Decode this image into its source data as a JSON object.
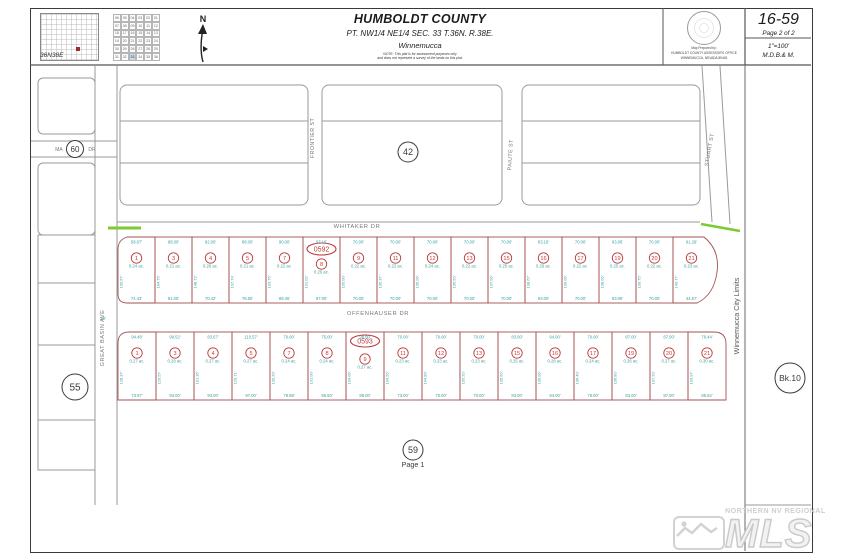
{
  "header": {
    "township_label": "36N38E",
    "north_label": "N",
    "section_grid": {
      "rows": [
        [
          "06",
          "05",
          "04",
          "03",
          "02",
          "01"
        ],
        [
          "07",
          "08",
          "09",
          "10",
          "11",
          "12"
        ],
        [
          "18",
          "17",
          "16",
          "15",
          "14",
          "13"
        ],
        [
          "19",
          "20",
          "21",
          "22",
          "23",
          "24"
        ],
        [
          "30",
          "29",
          "28",
          "27",
          "26",
          "25"
        ],
        [
          "31",
          "32",
          "33",
          "34",
          "35",
          "36"
        ]
      ],
      "highlight": "33"
    },
    "title": "HUMBOLDT COUNTY",
    "subtitle": "PT. NW1/4 NE1/4 SEC. 33 T.36N. R.38E.",
    "city": "Winnemucca",
    "note1": "NOTE: This plat is for assessment purposes only",
    "note2": "and does not represent a survey of the lands on this plat.",
    "seal_line1": "Map Prepared by:",
    "seal_line2": "HUMBOLDT COUNTY ASSESSOR'S OFFICE",
    "seal_line3": "WINNEMUCCA, NEVADA   89445",
    "map_number": "16-59",
    "page_label": "Page 2 of 2",
    "scale": "1\"=100'",
    "meridian": "M.D.B.& M."
  },
  "map": {
    "streets": {
      "whitaker": "WHITAKER DR",
      "offenhauser": "OFFENHAUSER DR",
      "frontier": "FRONTIER ST",
      "paiute": "PAIUTE ST",
      "stuart": "STUART ST",
      "great_basin": "GREAT BASIN AVE",
      "left_fragment_a": "MA",
      "left_fragment_b": "DR"
    },
    "refs": {
      "left_street_circle": "60",
      "block_circle": "42",
      "west_circle": "55",
      "south_circle": "59",
      "south_page": "Page 1",
      "book_circle": "Bk.10"
    },
    "ovals": {
      "upper": "0592",
      "lower": "0593"
    },
    "city_limits": "Winnemucca City Limits",
    "width_note": "30'",
    "upper_lots": [
      {
        "no": "1",
        "ac": "0.24 ac.",
        "top": "58.67'",
        "bottom": "74.43'",
        "side": "100.57'"
      },
      {
        "no": "3",
        "ac": "0.21 ac.",
        "top": "88.00'",
        "bottom": "91.05'",
        "side": "104.75'"
      },
      {
        "no": "4",
        "ac": "0.26 ac.",
        "top": "82.00'",
        "bottom": "70.42'",
        "side": "148.72'"
      },
      {
        "no": "5",
        "ac": "0.21 ac.",
        "top": "88.00'",
        "bottom": "78.50'",
        "side": "137.74'"
      },
      {
        "no": "7",
        "ac": "0.22 ac.",
        "top": "90.00'",
        "bottom": "89.45'",
        "side": "133.75'"
      },
      {
        "no": "8",
        "ac": "0.25 ac.",
        "top": "97.16'",
        "bottom": "97.00'",
        "side": "131.02'"
      },
      {
        "no": "9",
        "ac": "0.22 ac.",
        "top": "70.00'",
        "bottom": "70.00'",
        "side": "135.00'"
      },
      {
        "no": "11",
        "ac": "0.22 ac.",
        "top": "70.00'",
        "bottom": "70.00'",
        "side": "135.37'"
      },
      {
        "no": "12",
        "ac": "0.24 ac.",
        "top": "70.00'",
        "bottom": "70.00'",
        "side": "136.00'"
      },
      {
        "no": "13",
        "ac": "0.22 ac.",
        "top": "70.00'",
        "bottom": "70.00'",
        "side": "136.50'"
      },
      {
        "no": "15",
        "ac": "0.25 ac.",
        "top": "70.00'",
        "bottom": "70.00'",
        "side": "137.00'"
      },
      {
        "no": "16",
        "ac": "0.26 ac.",
        "top": "63.16'",
        "bottom": "93.00'",
        "side": "138.67'"
      },
      {
        "no": "17",
        "ac": "0.22 ac.",
        "top": "70.00'",
        "bottom": "70.00'",
        "side": "139.00'"
      },
      {
        "no": "19",
        "ac": "0.25 ac.",
        "top": "93.06'",
        "bottom": "93.06'",
        "side": "138.00'"
      },
      {
        "no": "20",
        "ac": "0.22 ac.",
        "top": "70.00'",
        "bottom": "70.00'",
        "side": "139.75'"
      },
      {
        "no": "21",
        "ac": "0.23 ac.",
        "top": "91.29'",
        "bottom": "44.57'",
        "side": "140.77'"
      }
    ],
    "lower_lots": [
      {
        "no": "1",
        "ac": "0.27 ac.",
        "top": "94.48'",
        "bottom": "73.97'",
        "side": "128.37'"
      },
      {
        "no": "3",
        "ac": "0.28 ac.",
        "top": "99.52'",
        "bottom": "93.00'",
        "side": "129.57'"
      },
      {
        "no": "4",
        "ac": "0.27 ac.",
        "top": "83.67'",
        "bottom": "93.00'",
        "side": "131.35'"
      },
      {
        "no": "5",
        "ac": "0.27 ac.",
        "top": "110.57'",
        "bottom": "97.00'",
        "side": "129.71'"
      },
      {
        "no": "7",
        "ac": "0.24 ac.",
        "top": "70.00'",
        "bottom": "79.98'",
        "side": "130.20'"
      },
      {
        "no": "8",
        "ac": "0.24 ac.",
        "top": "75.00'",
        "bottom": "85.50'",
        "side": "131.00'"
      },
      {
        "no": "9",
        "ac": "0.27 ac.",
        "top": "98.00'",
        "bottom": "88.00'",
        "side": "134.00'"
      },
      {
        "no": "11",
        "ac": "0.23 ac.",
        "top": "70.00'",
        "bottom": "73.00'",
        "side": "134.50'"
      },
      {
        "no": "12",
        "ac": "0.23 ac.",
        "top": "70.00'",
        "bottom": "70.00'",
        "side": "134.80'"
      },
      {
        "no": "13",
        "ac": "0.23 ac.",
        "top": "70.00'",
        "bottom": "70.00'",
        "side": "135.20'"
      },
      {
        "no": "15",
        "ac": "0.25 ac.",
        "top": "83.00'",
        "bottom": "83.00'",
        "side": "135.60'"
      },
      {
        "no": "16",
        "ac": "0.28 ac.",
        "top": "94.00'",
        "bottom": "94.00'",
        "side": "136.00'"
      },
      {
        "no": "17",
        "ac": "0.24 ac.",
        "top": "70.00'",
        "bottom": "78.00'",
        "side": "136.40'"
      },
      {
        "no": "19",
        "ac": "0.26 ac.",
        "top": "87.00'",
        "bottom": "83.00'",
        "side": "136.80'"
      },
      {
        "no": "20",
        "ac": "0.27 ac.",
        "top": "87.00'",
        "bottom": "87.00'",
        "side": "137.20'"
      },
      {
        "no": "21",
        "ac": "0.30 ac.",
        "top": "76.44'",
        "bottom": "85.52'",
        "side": "133.97'"
      }
    ]
  },
  "watermark": {
    "line1": "NORTHERN NV REGIONAL",
    "logo": "MLS"
  }
}
